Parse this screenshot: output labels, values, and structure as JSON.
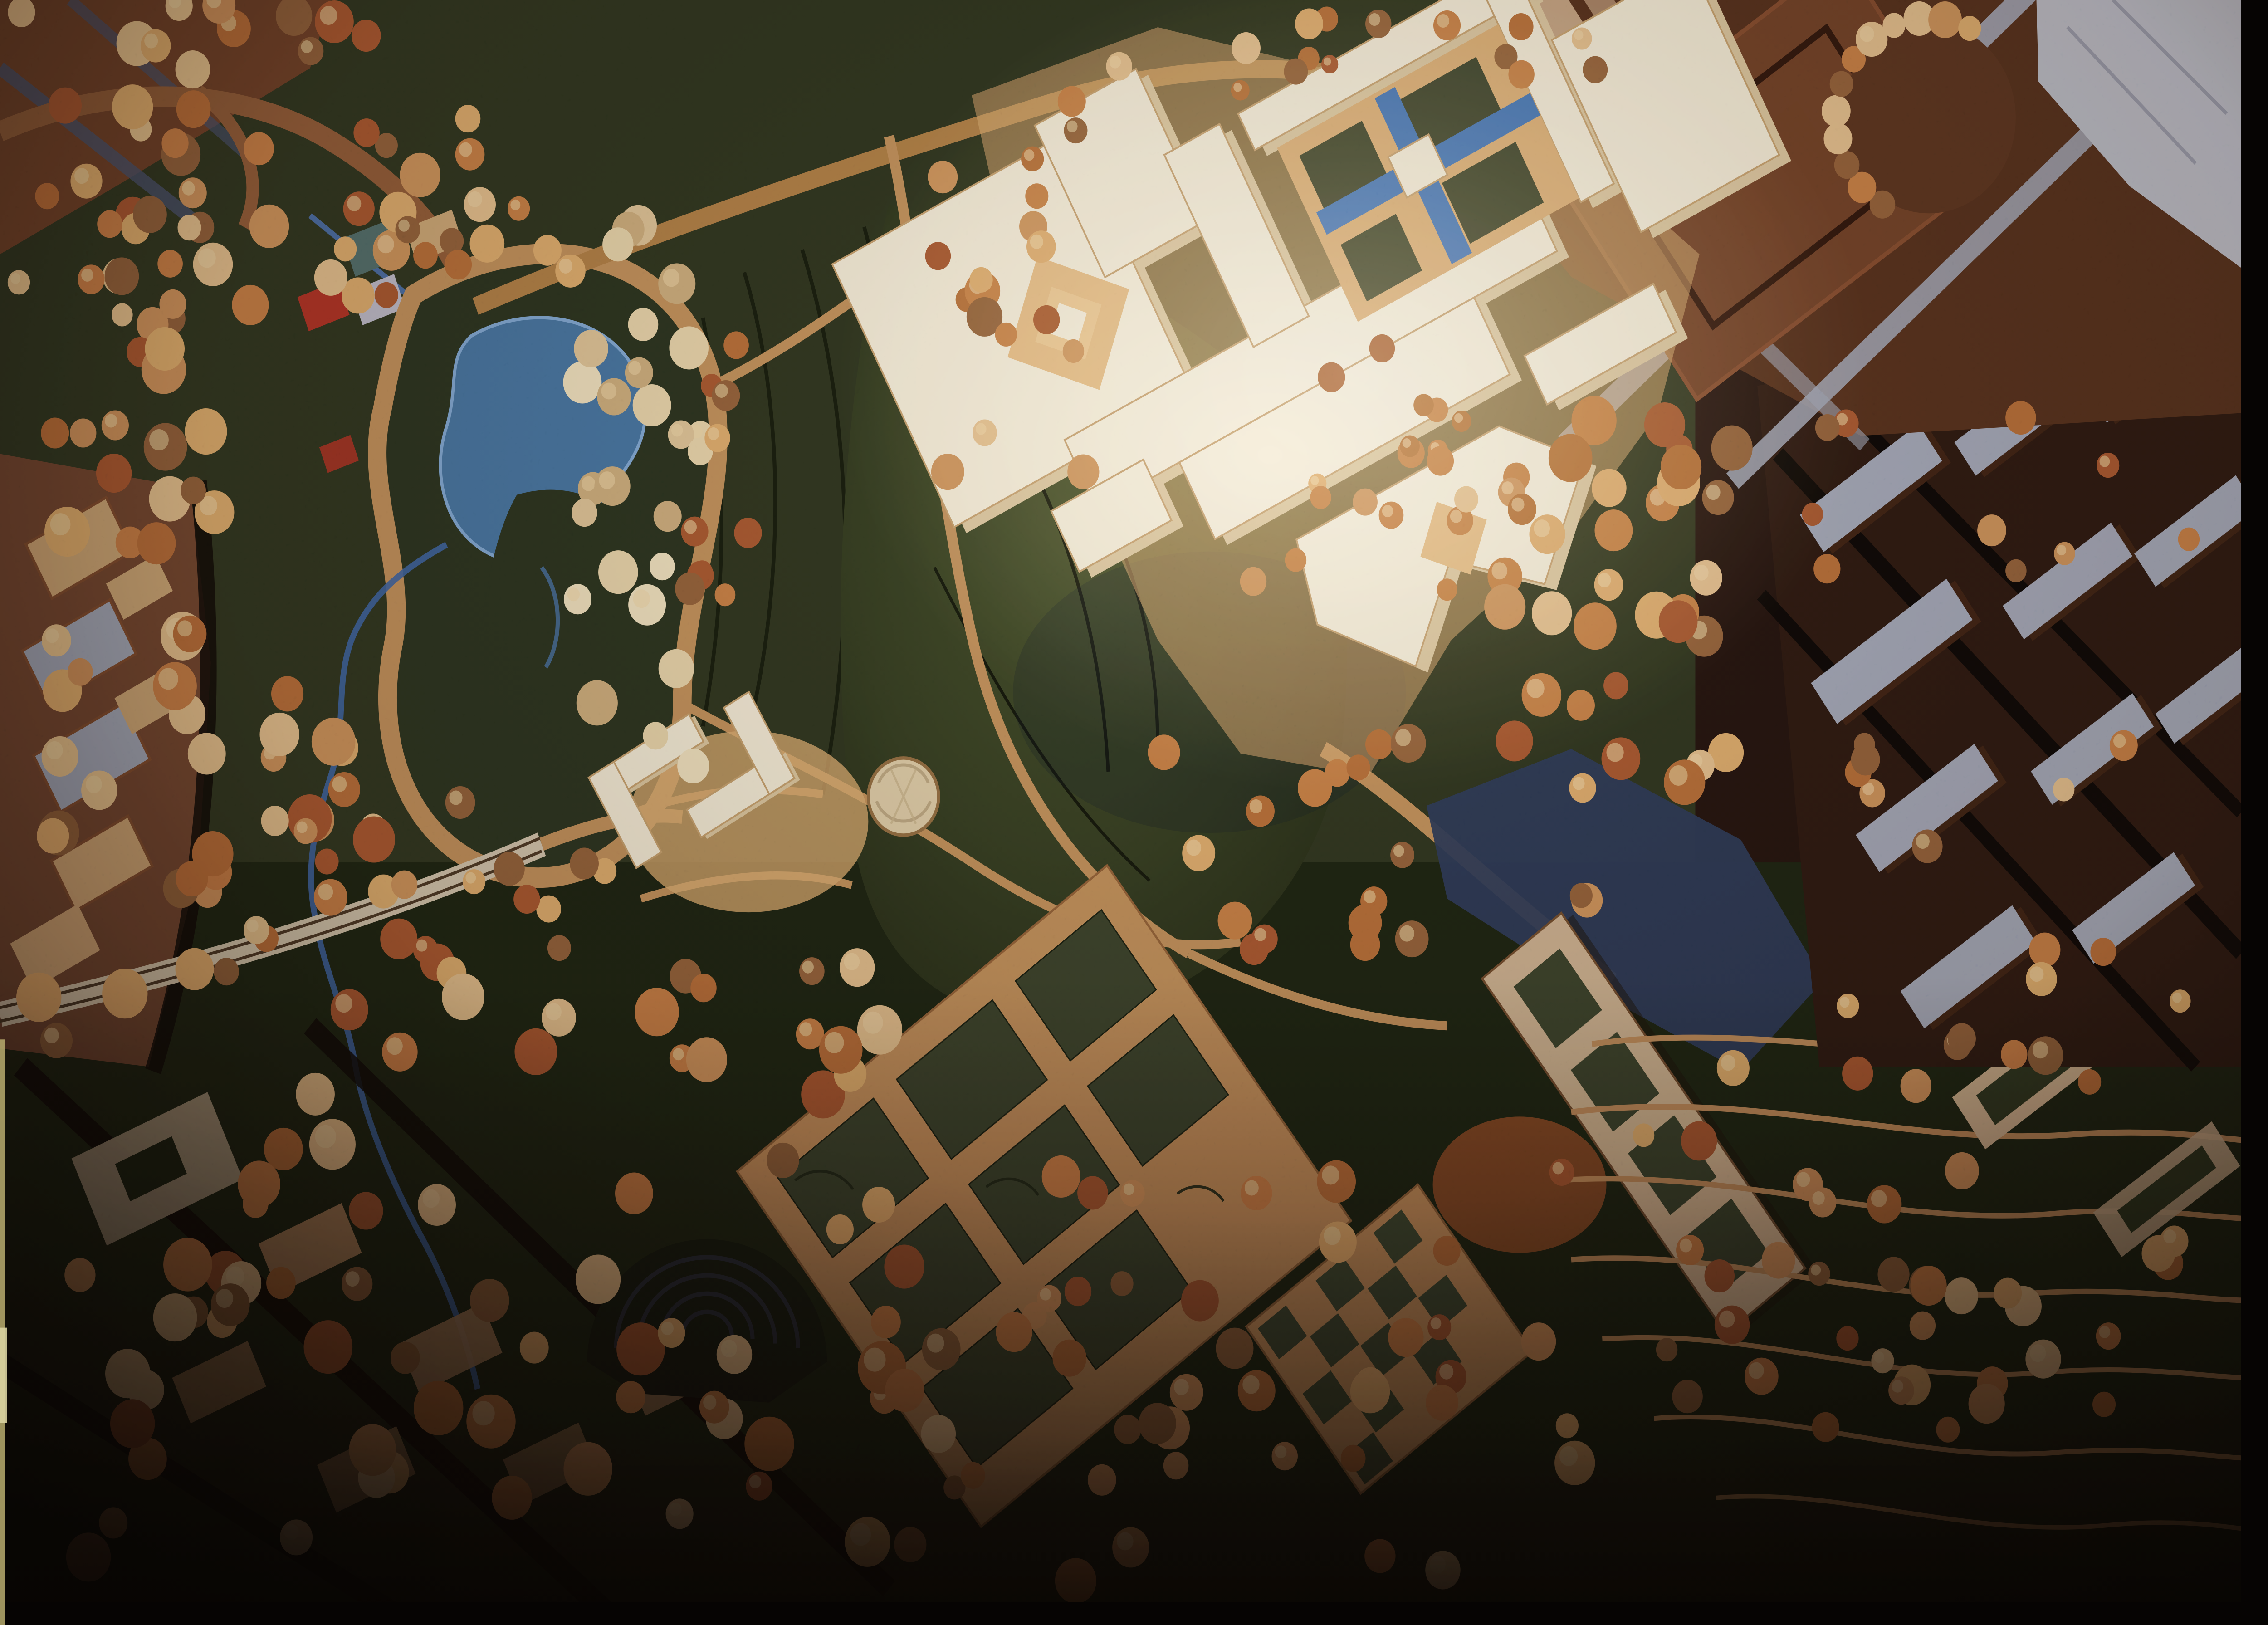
{
  "meta": {
    "title": "Architectural site model — aerial photograph",
    "media_type": "film photograph of a physical scale model",
    "description": "Aerial view of a large architectural scale model: an illuminated cream-white museum complex with interlocking wings, courtyards and blue reflecting pools sits in dark wooded parkland with a blue pond, curving tan roads, a bridge with lane lines, formal garden grids, a terraced amphitheater bowl, contoured hillside terraces, and surrounding red-brown city blocks with blue-gray rooftops; warm-toned film with heavy vignetting and black frame edges on the right and bottom."
  },
  "scene": {
    "regions": [
      {
        "name": "museum-complex",
        "desc": "illuminated cream-white modernist building cluster with diamond courtyards"
      },
      {
        "name": "reflecting-pools",
        "desc": "cross-shaped blue water channels with green garden squares in central court"
      },
      {
        "name": "pond",
        "desc": "blue kidney-shaped pond with dark island and tan shore path"
      },
      {
        "name": "park",
        "desc": "dark olive-green parkland with contour lines and scattered model trees"
      },
      {
        "name": "bridge-road",
        "desc": "pale curving road with two dark lane lines entering from the left edge"
      },
      {
        "name": "stream",
        "desc": "thin blue stream meandering from the pond toward the bottom"
      },
      {
        "name": "l-shaped-pavilions",
        "desc": "small white L-shaped buildings with round domed pavilion"
      },
      {
        "name": "formal-garden-grid",
        "desc": "rotated tan path grid framing dark green planting beds"
      },
      {
        "name": "checkerboard-garden",
        "desc": "small checkerboard parcel of green and tan squares"
      },
      {
        "name": "diagonal-slab-building",
        "desc": "long tan slab building with green courtyard strips beside a blue-shadowed street"
      },
      {
        "name": "amphitheater-bowl",
        "desc": "dark concentric-ring terraced bowl among trees"
      },
      {
        "name": "terraced-hillside",
        "desc": "dark green slopes with curving tan contour roads lined by trees"
      },
      {
        "name": "city-blocks-top-right",
        "desc": "large red-brown blocks, pale blue-gray streets and plaza, curved tree court"
      },
      {
        "name": "city-blocks-right",
        "desc": "rows of small buildings with blue-gray rooftops"
      },
      {
        "name": "city-edge-left",
        "desc": "red-brown blocks with tan rooftop slabs"
      },
      {
        "name": "residential-bottom-left",
        "desc": "dark residential quarter with tan roofs and dense orange trees"
      },
      {
        "name": "model-trees",
        "desc": "hundreds of fluffy orange, rust and pale-tan model trees"
      },
      {
        "name": "film-frame",
        "desc": "black film edge bands at right and bottom, pale sliver on lower left edge"
      }
    ]
  },
  "palette": {
    "base_dark": "#241510",
    "park_green": "#2e3520",
    "park_green_dark": "#20271607",
    "park_low": "#1d2413",
    "lawn_light": "#3d4729",
    "contour_dark": "#15190d",
    "path_tan": "#bc8a5a",
    "road_top": "#a97a46",
    "road_light": "#cfc2ab",
    "road_lines": "#4a3826",
    "pond_blue": "#44719f",
    "pond_edge": "#79a3d4",
    "stream_blue": "#3c62a0",
    "island_green": "#2a3320",
    "cream_building": "#f3ead5",
    "cream_shadow": "#d8c29b",
    "cream_edge": "#c09a6c",
    "courtyard_tan": "#d8a871",
    "courtyard_tan2": "#e2b67f",
    "pool_blue": "#3f6fb2",
    "garden_green": "#39412c",
    "city_brown_dark": "#52301d",
    "city_brown": "#6b4028",
    "city_block_edge": "#7d4a2f",
    "roof_bluegray": "#9aa2b6",
    "plaza_pale": "#b4b8c5",
    "plaza_line": "#8e93a6",
    "left_city_brown": "#6e4530",
    "left_city_roof": "#c9a275",
    "left_city_side": "#7a4a2e",
    "resi_roof": "#a9805b",
    "resi_pale": "#b2a188",
    "red_roof": "#a93226",
    "teal_roof": "#4e6a6a",
    "pale_block": "#b7b7c9",
    "canyon_blue": "#2c3a57",
    "slab_tan": "#c9ad8e",
    "orange_ground": "#8f4e28",
    "checker_green": "#3c4630",
    "contour_tan": "#b9885a",
    "street_dark": "#0f0a07",
    "dome_fill": "#dcc9a5",
    "dome_edge": "#8a6a42",
    "shadow_cast": "#141b2a",
    "film_edge": "#060403",
    "film_sliver": "#b9ad6f",
    "highlight_warm": "#ffe9c0",
    "tree_warm": [
      "#c98d5a",
      "#dca76b",
      "#b06a38",
      "#e2bb8a",
      "#a05530",
      "#8a5e3a",
      "#c27a45"
    ],
    "tree_pale": [
      "#e7d2a8",
      "#dcc094",
      "#c9a87a",
      "#efe0bd"
    ],
    "tree_highlight": "#eed3a4"
  }
}
